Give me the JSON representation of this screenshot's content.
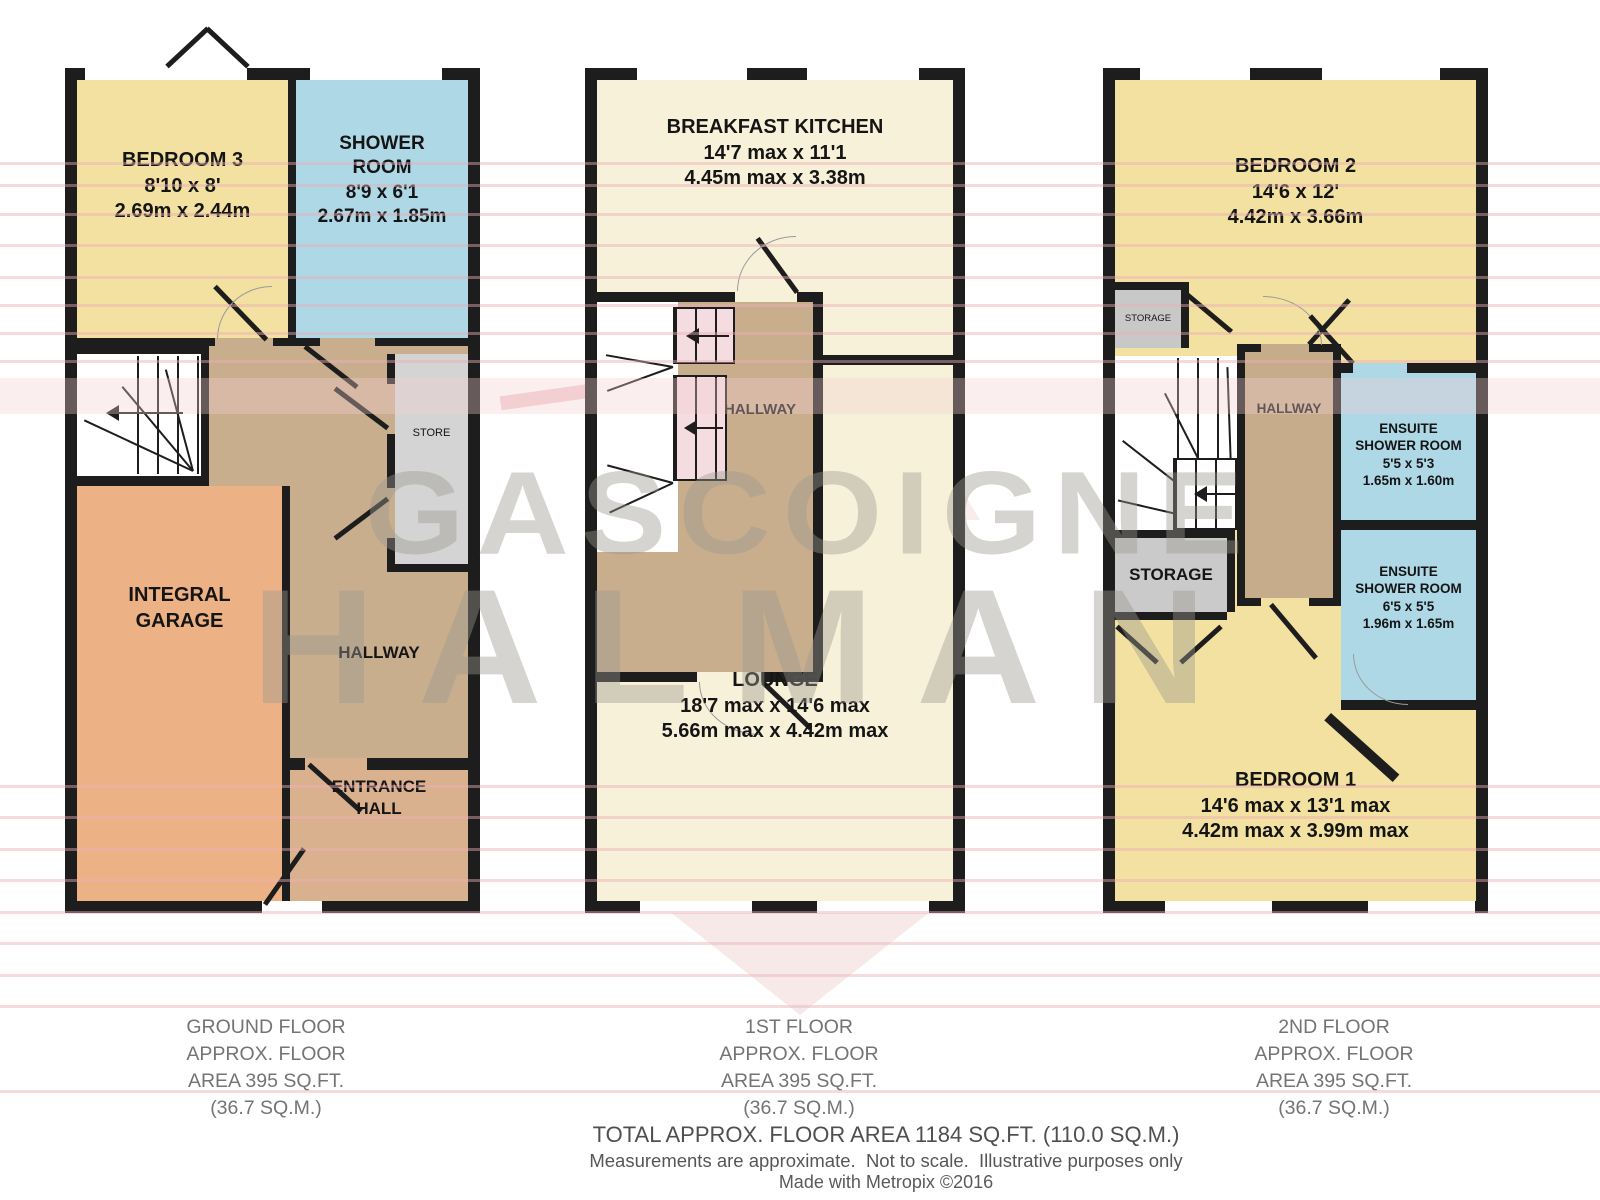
{
  "watermark": {
    "line1": "GASCOIGNE",
    "line2": "HALMAN"
  },
  "floors": [
    {
      "caption": "GROUND FLOOR\nAPPROX. FLOOR\nAREA 395 SQ.FT.\n(36.7 SQ.M.)",
      "rooms": {
        "bedroom3": "BEDROOM 3\n8'10 x 8'\n2.69m x 2.44m",
        "shower": "SHOWER\nROOM\n8'9 x 6'1\n2.67m x 1.85m",
        "garage": "INTEGRAL\nGARAGE",
        "hallway": "HALLWAY",
        "store": "STORE",
        "entrance": "ENTRANCE\nHALL"
      }
    },
    {
      "caption": "1ST FLOOR\nAPPROX. FLOOR\nAREA 395 SQ.FT.\n(36.7 SQ.M.)",
      "rooms": {
        "kitchen": "BREAKFAST KITCHEN\n14'7 max x 11'1\n4.45m max x 3.38m",
        "hallway": "HALLWAY",
        "lounge": "LOUNGE\n18'7 max x 14'6 max\n5.66m max x 4.42m max"
      }
    },
    {
      "caption": "2ND FLOOR\nAPPROX. FLOOR\nAREA 395 SQ.FT.\n(36.7 SQ.M.)",
      "rooms": {
        "bedroom2": "BEDROOM 2\n14'6 x 12'\n4.42m x 3.66m",
        "storage_small": "STORAGE",
        "hallway": "HALLWAY",
        "ensuite1": "ENSUITE\nSHOWER ROOM\n5'5 x 5'3\n1.65m x 1.60m",
        "storage": "STORAGE",
        "ensuite2": "ENSUITE\nSHOWER ROOM\n6'5 x 5'5\n1.96m x 1.65m",
        "bedroom1": "BEDROOM 1\n14'6 max x 13'1 max\n4.42m max x 3.99m max"
      }
    }
  ],
  "footer": {
    "total": "TOTAL APPROX. FLOOR AREA 1184 SQ.FT. (110.0 SQ.M.)",
    "disclaimer": "Measurements are approximate.  Not to scale.  Illustrative purposes only",
    "credit": "Made with Metropix ©2016"
  },
  "colors": {
    "bedroom_yellow": "#f2e1a0",
    "bathroom_blue": "#aed8e6",
    "garage_orange": "#ecb285",
    "hallway_tan": "#c9ae8e",
    "entrance_tan": "#d9b18e",
    "cream": "#f8f1da",
    "stair_pink": "#f4dce1",
    "storage_gray": "#cacaca",
    "wall_black": "#1d1d1d",
    "stripe_pink": "#f0c9ce",
    "watermark_gray": "#9e988e"
  }
}
